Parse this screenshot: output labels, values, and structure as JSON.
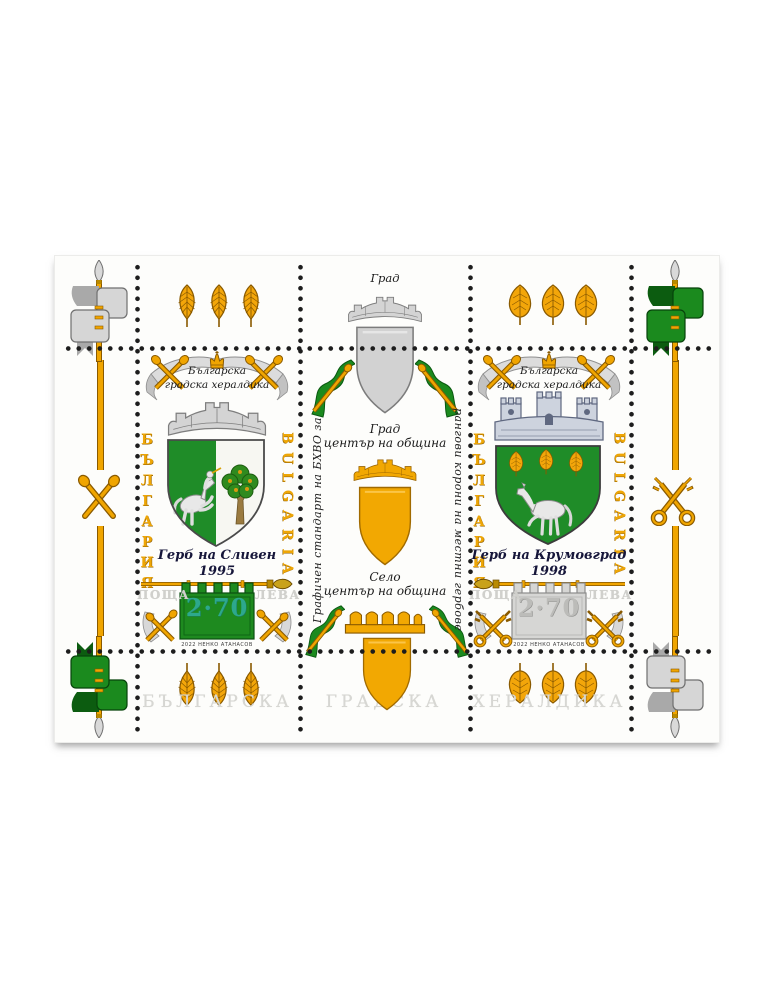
{
  "sheet": {
    "bottom_title": [
      "БЪЛГАРСКА",
      "ГРАДСКА",
      "ХЕРАЛДИКА"
    ],
    "colors": {
      "gold": "#f0a500",
      "green": "#1f8c28",
      "silver": "#d2d2d2",
      "steel_blue_crown": "#cdd3de",
      "teal_value": "#2da88c",
      "ink": "#16163a",
      "pale_lettering": "#d7d7d3"
    },
    "decorations": {
      "top_left_corner": "silver-ribbon-flag-spear-up",
      "top_right_corner": "green-flag-spear-up",
      "bottom_left_corner": "green-flag-spear-down",
      "bottom_right_corner": "silver-ribbon-flag-spear-down",
      "top_left_leaves": "three-gold-beech-leaves",
      "top_right_leaves": "three-gold-linden-leaves",
      "bottom_left_leaves": "three-gold-beech-leaves-inverted",
      "bottom_right_leaves": "three-gold-linden-leaves-inverted",
      "left_margin": "crossed-gold-maces-on-staff",
      "right_margin": "crossed-gold-keys-on-staff"
    }
  },
  "center_column": {
    "top_label": "Град",
    "top_crown": "silver-mural-crown-with-silver-shield",
    "city_label": [
      "Град",
      "център на община"
    ],
    "city_crown": "gold-mural-crown-with-gold-shield",
    "village_label": [
      "Село",
      "център на община"
    ],
    "village_crown": "gold-village-crown-with-gold-shield",
    "left_vertical_text": "Графичен стандарт на БХВО за",
    "right_vertical_text": "рангови корони на местни гербове"
  },
  "stamps": [
    {
      "name": "sliven",
      "ribbon": [
        "Българска",
        "градска хералдика"
      ],
      "country_cyrillic": "БЪЛГАРИЯ",
      "country_latin": "BULGARIA",
      "caption": "Герб на Сливен",
      "year": "1995",
      "post_label": "ПОЩА",
      "currency_label": "ЛЕВА",
      "value": "2·70",
      "credit": "2022 НЕНКО АТАНАСОВ",
      "arms": "silver-horseman-with-trumpet-on-green-and-green-oak-on-silver"
    },
    {
      "name": "krumovgrad",
      "ribbon": [
        "Българска",
        "градска хералдика"
      ],
      "country_cyrillic": "БЪЛГАРИЯ",
      "country_latin": "BULGARIA",
      "caption": "Герб на Крумовград",
      "year": "1998",
      "post_label": "ПОЩА",
      "currency_label": "ЛЕВА",
      "value": "2·70",
      "credit": "2022 НЕНКО АТАНАСОВ",
      "arms": "silver-horse-and-three-gold-linden-leaves-on-green"
    }
  ]
}
